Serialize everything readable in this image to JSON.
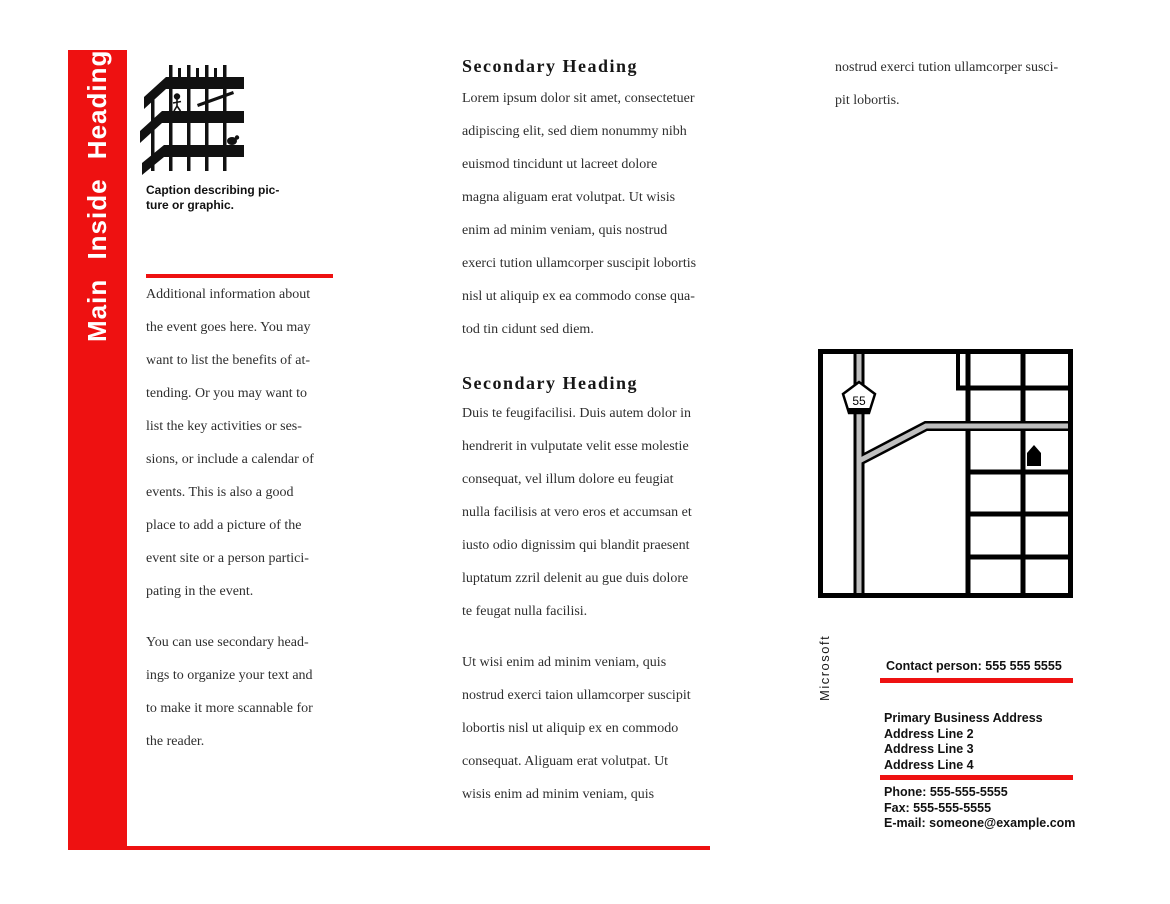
{
  "colors": {
    "accent_red": "#ee1111",
    "ink": "#111111",
    "body_text": "#2e2e2e",
    "road_gray": "#bfbfbf",
    "heading_white": "#ffffff"
  },
  "left_panel": {
    "vertical_heading": "Main Inside Heading"
  },
  "left_column": {
    "caption_lines": [
      "Caption describing pic-",
      "ture or graphic."
    ],
    "paragraph1_lines": [
      "Additional information about",
      "the event goes here. You may",
      "want to list the benefits of at-",
      "tending. Or you may want to",
      "list the key activities or ses-",
      "sions, or include a calendar of",
      "events. This is also a good",
      "place to add a picture of the",
      "event site or a person partici-",
      "pating in the event."
    ],
    "paragraph2_lines": [
      "You can use secondary head-",
      "ings to organize your text and",
      "to make it more scannable for",
      "the reader."
    ]
  },
  "center_column": {
    "section1": {
      "heading": "Secondary Heading",
      "lines": [
        "Lorem ipsum dolor sit amet, consectetuer",
        "adipiscing elit, sed diem nonummy nibh",
        "euismod tincidunt ut lacreet dolore",
        "magna aliguam erat volutpat. Ut wisis",
        "enim ad minim veniam, quis nostrud",
        "exerci tution ullamcorper suscipit lobortis",
        "nisl ut aliquip ex ea commodo conse qua-",
        "tod tin cidunt sed diem."
      ]
    },
    "section2": {
      "heading": "Secondary Heading",
      "lines": [
        "Duis te feugifacilisi. Duis autem dolor in",
        "hendrerit in vulputate velit esse molestie",
        "consequat, vel illum dolore eu feugiat",
        "nulla facilisis at vero eros et accumsan et",
        "iusto odio dignissim qui blandit praesent",
        "luptatum zzril delenit au gue duis dolore",
        "te feugat nulla facilisi."
      ]
    },
    "paragraph3_lines": [
      "Ut wisi enim ad minim veniam, quis",
      "nostrud exerci taion ullamcorper suscipit",
      "lobortis nisl ut aliquip ex en commodo",
      "consequat. Aliguam erat volutpat. Ut",
      "wisis enim ad minim veniam, quis"
    ]
  },
  "right_column": {
    "continued_lines": [
      "nostrud exerci tution ullamcorper susci-",
      "pit lobortis."
    ],
    "map": {
      "route_number": "55"
    },
    "publisher_text": "Microsoft",
    "contact": {
      "person_line": "Contact person: 555 555 5555",
      "address_lines": [
        "Primary Business Address",
        "Address Line 2",
        "Address Line 3",
        "Address Line 4"
      ],
      "phone_line": "Phone: 555-555-5555",
      "fax_line": "Fax: 555-555-5555",
      "email_line": "E-mail: someone@example.com"
    }
  }
}
